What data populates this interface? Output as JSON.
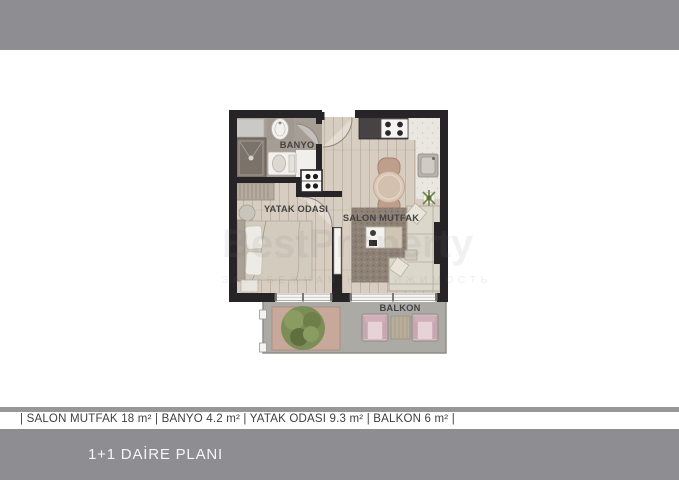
{
  "plan": {
    "labels": {
      "banyo": "BANYO",
      "yatak_odasi": "YATAK ODASI",
      "salon_mutfak": "SALON MUTFAK",
      "balkon": "BALKON"
    },
    "colors": {
      "wall": "#262427",
      "wood_floor": "#d7cdc0",
      "banyo_floor": "#a69d94",
      "balcony_floor": "#abaaa5",
      "planter": "#c8a89b",
      "tree_green": "#7c8d55",
      "chair_pink": "#d9bdc6",
      "sofa_cream": "#dcd7cb",
      "rug": "#8e8175"
    }
  },
  "watermark": {
    "line1": "BestProperty",
    "line2": "ЗАРУБЕЖНАЯ НЕДВИЖИМОСТЬ"
  },
  "areas_line": "| SALON MUTFAK 18 m² | BANYO 4.2 m² | YATAK ODASI 9.3 m² | BALKON 6 m² |",
  "footer": {
    "title": "1+1 DAİRE PLANI"
  },
  "bars": {
    "color": "#8e8d92"
  }
}
